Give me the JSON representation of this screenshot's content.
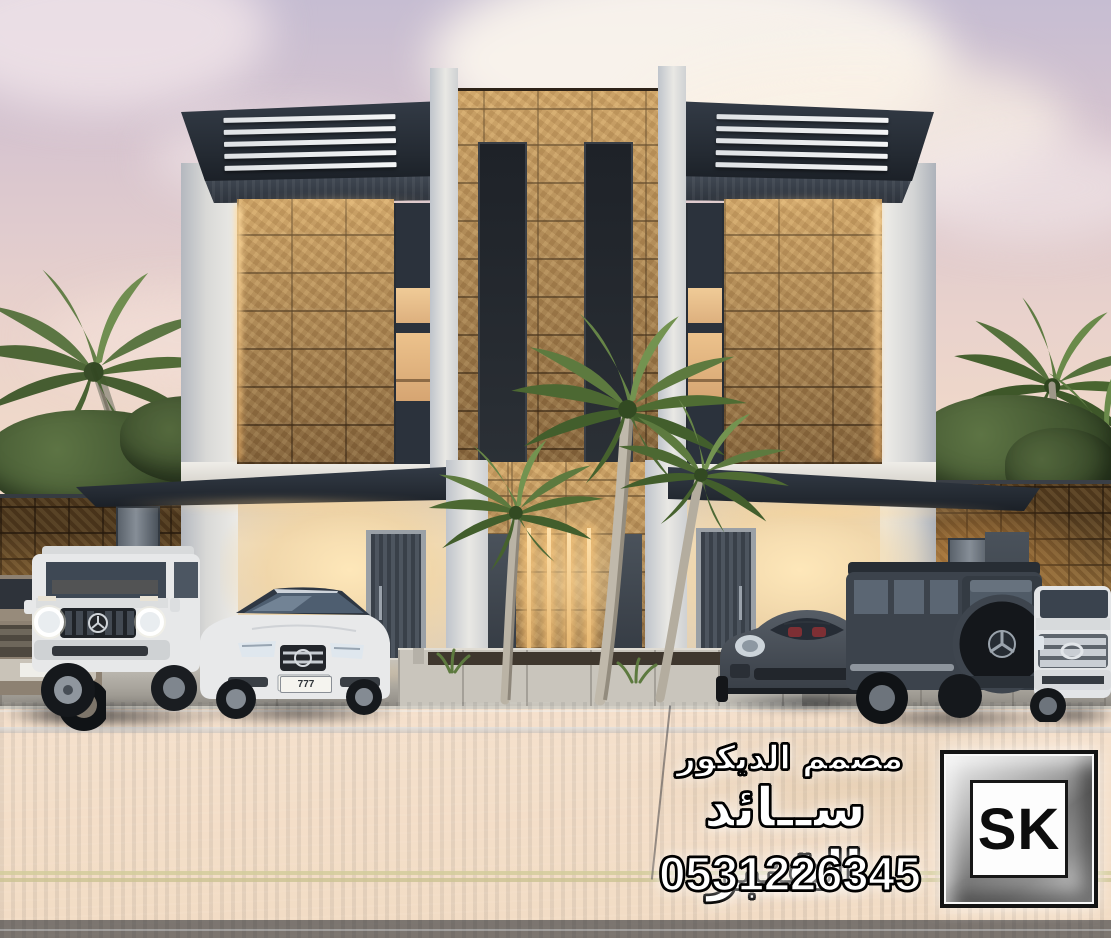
{
  "watermark": {
    "profession": "مصمم الديكور",
    "name": "ســائد القنبر",
    "phone": "0531226345",
    "logo": "SK"
  },
  "cars": {
    "sedan_plate": "777"
  },
  "palette": {
    "sky_top": "#c6bdd2",
    "sky_horizon": "#f6e2cf",
    "stone": "#c9a268",
    "stone_lit": "#e8b879",
    "canopy_dark": "#2a313b",
    "wall_white": "#e8e7e4",
    "ground_glow": "#f6e5c6",
    "door_dark": "#454c55",
    "road": "#5a6575",
    "lane_yellow": "#d2cc9b",
    "palm_green": "#5d7a3f",
    "car_white": "#e7e8e9",
    "car_dark_gray": "#3c434c"
  }
}
